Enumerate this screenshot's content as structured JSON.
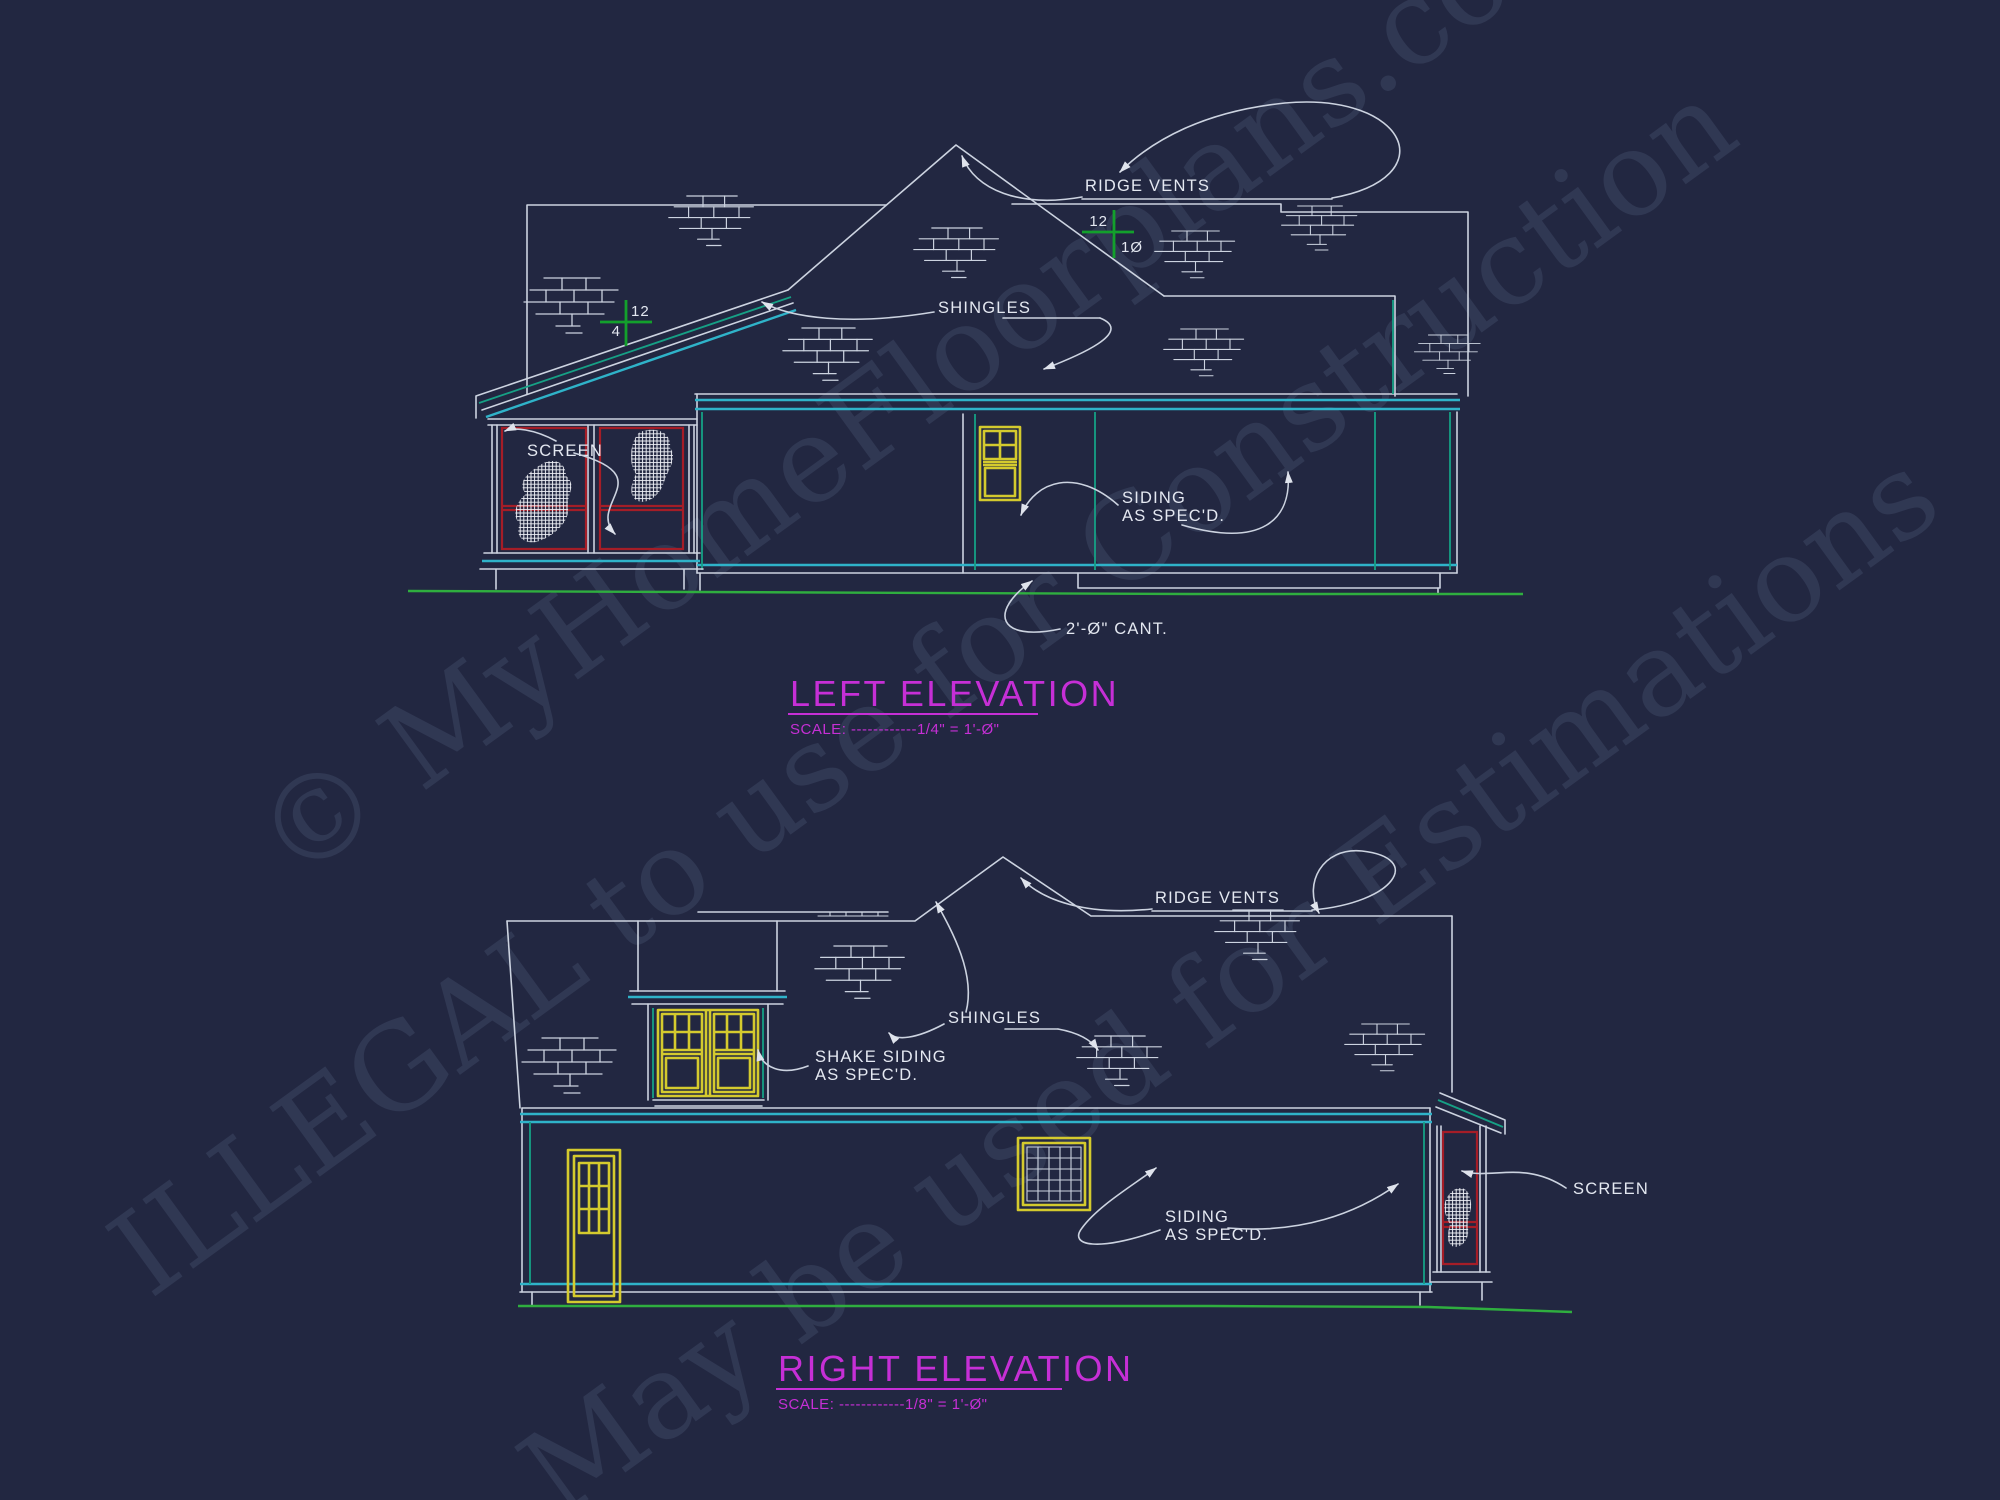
{
  "drawing": {
    "colors": {
      "bg": "#222741",
      "line": "#ccd3e0",
      "text": "#e4e8f1",
      "cyan": "#2fb3c9",
      "teal": "#16a085",
      "green": "#2fae3f",
      "mgreen": "#13a02c",
      "red": "#a51d27",
      "yellow": "#d4ca2e",
      "magenta": "#c62fd6",
      "wm": "#3d4663"
    },
    "watermark": {
      "line1": "© MyHomeFloorplans.com",
      "line2": "ILLEGAL to use for Construction",
      "line3": "May be used for Estimations"
    },
    "left_elevation": {
      "title": "LEFT ELEVATION",
      "scale": "SCALE: ------------1/4\" = 1'-Ø\"",
      "labels": {
        "ridge_vents": "RIDGE VENTS",
        "shingles": "SHINGLES",
        "screen": "SCREEN",
        "siding1": "SIDING",
        "siding2": "AS SPEC'D.",
        "cant": "2'-Ø\" CANT.",
        "slope_main_rise": "12",
        "slope_main_run": "1Ø",
        "slope_porch_rise": "12",
        "slope_porch_run": "4"
      }
    },
    "right_elevation": {
      "title": "RIGHT ELEVATION",
      "scale": "SCALE: ------------1/8\" = 1'-Ø\"",
      "labels": {
        "ridge_vents": "RIDGE VENTS",
        "shingles": "SHINGLES",
        "shake1": "SHAKE SIDING",
        "shake2": "AS SPEC'D.",
        "siding1": "SIDING",
        "siding2": "AS SPEC'D.",
        "screen": "SCREEN"
      }
    }
  }
}
